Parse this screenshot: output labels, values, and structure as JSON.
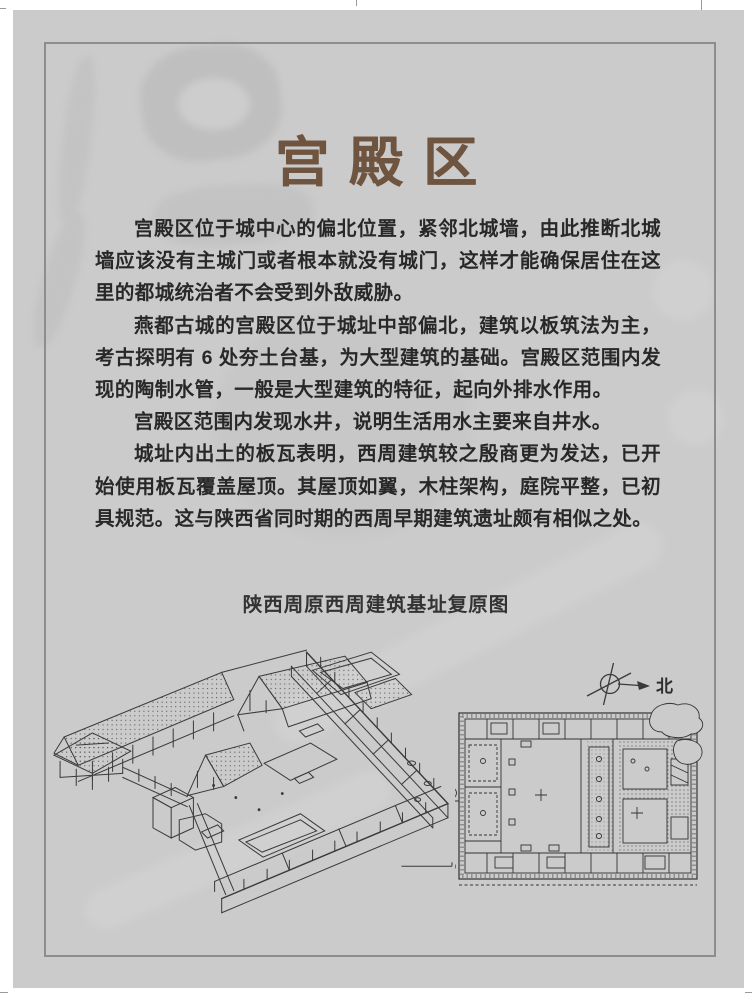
{
  "page": {
    "title": "宫殿区",
    "paragraphs": [
      "宫殿区位于城中心的偏北位置，紧邻北城墙，由此推断北城墙应该没有主城门或者根本就没有城门，这样才能确保居住在这里的都城统治者不会受到外敌威胁。",
      "燕都古城的宫殿区位于城址中部偏北，建筑以板筑法为主，考古探明有 6 处夯土台基，为大型建筑的基础。宫殿区范围内发现的陶制水管，一般是大型建筑的特征，起向外排水作用。",
      "宫殿区范围内发现水井，说明生活用水主要来自井水。",
      "城址内出土的板瓦表明，西周建筑较之殷商更为发达，已开始使用板瓦覆盖屋顶。其屋顶如翼，木柱架构，庭院平整，已初具规范。这与陕西省同时期的西周早期建筑遗址颇有相似之处。"
    ],
    "figure": {
      "caption": "陕西周原西周建筑基址复原图",
      "north_label": "北",
      "scale_label": "0米"
    },
    "colors": {
      "page_background": "#cbcbcb",
      "frame_border": "#8d8d8d",
      "title_brown": "#6f5440",
      "body_text": "#282828",
      "line_art": "#3a3a3a"
    }
  }
}
